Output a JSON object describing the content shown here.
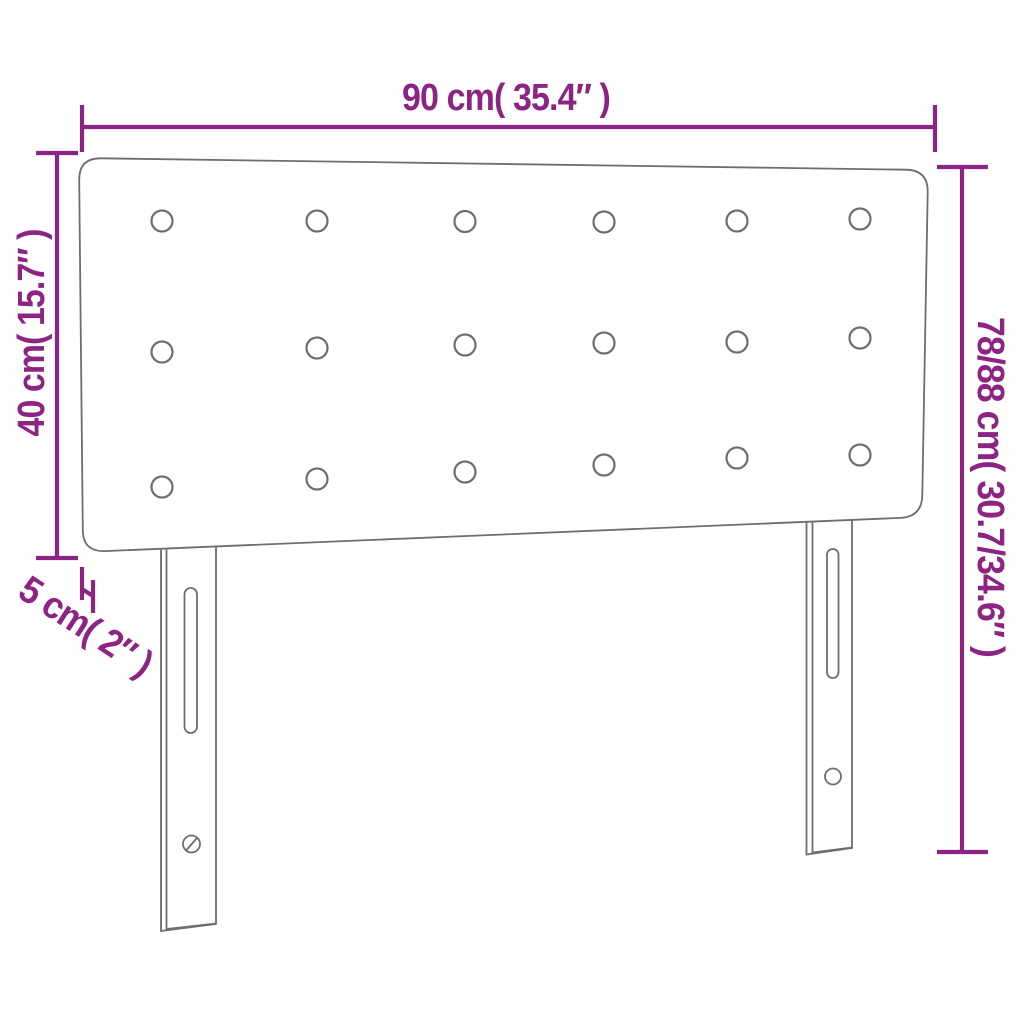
{
  "title": "Headboard dimension diagram",
  "colors": {
    "dimension": "#8d2383",
    "outline": "#6e6e6e",
    "background": "#ffffff"
  },
  "labels": {
    "width": "90 cm( 35.4″ )",
    "panel_height": "40 cm( 15.7″ )",
    "thickness": "5 cm( 2″ )",
    "total_height": "78/88 cm( 30.7/34.6″ )"
  },
  "values": {
    "width_cm": 90,
    "width_in": 35.4,
    "panel_height_cm": 40,
    "panel_height_in": 15.7,
    "thickness_cm": 5,
    "thickness_in": 2,
    "total_height_cm_min": 78,
    "total_height_cm_max": 88,
    "total_height_in_min": 30.7,
    "total_height_in_max": 34.6
  },
  "figure": {
    "tufting_button_rows": 3,
    "tufting_buttons_per_row": 6,
    "legs": 2
  }
}
